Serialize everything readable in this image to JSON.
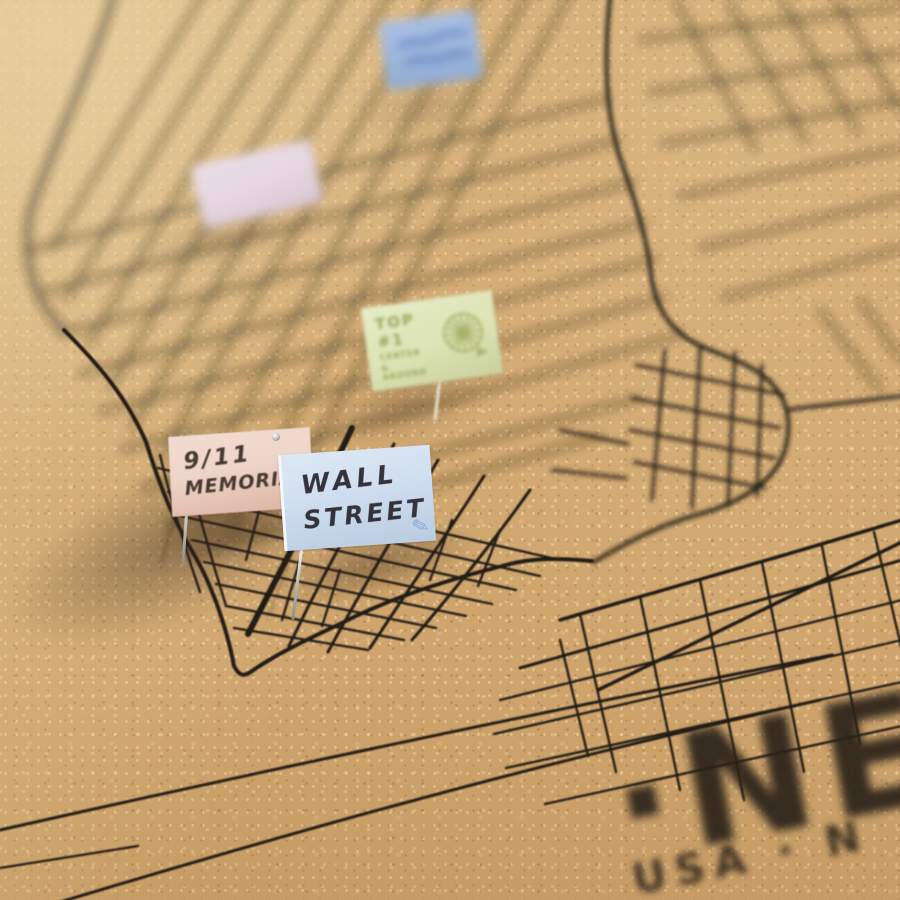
{
  "colors": {
    "cork": "#cfa56d",
    "cork_light": "#e8cfa0",
    "cork_dark": "#8a6540",
    "map_line": "#241e18",
    "caption_ink": "#2a2219",
    "flag_blue_top": "#a9c0e6",
    "flag_lavender": "#e4d4e0",
    "flag_green": "#dce3b4",
    "flag_green_ink": "#99a45c",
    "flag_pink": "#eed5c9",
    "flag_pink_ink": "#463a31",
    "flag_blue": "#cfdeef",
    "flag_blue_ink": "#35323c",
    "pencil_blue": "#8aa6d6",
    "pin_metal": "#c9c9c5"
  },
  "flags": {
    "top1": {
      "title": "TOP #1",
      "sub1": "CENTER",
      "sub2": "& AROUND"
    },
    "memorial": {
      "line1": "9/11",
      "line2": "MEMORIAL"
    },
    "wall_street": {
      "line1": "WALL",
      "line2": "STREET",
      "pencil_glyph": "✎"
    }
  },
  "caption": {
    "title_fragment": "·NE",
    "subtitle_fragment": "USA · N"
  }
}
